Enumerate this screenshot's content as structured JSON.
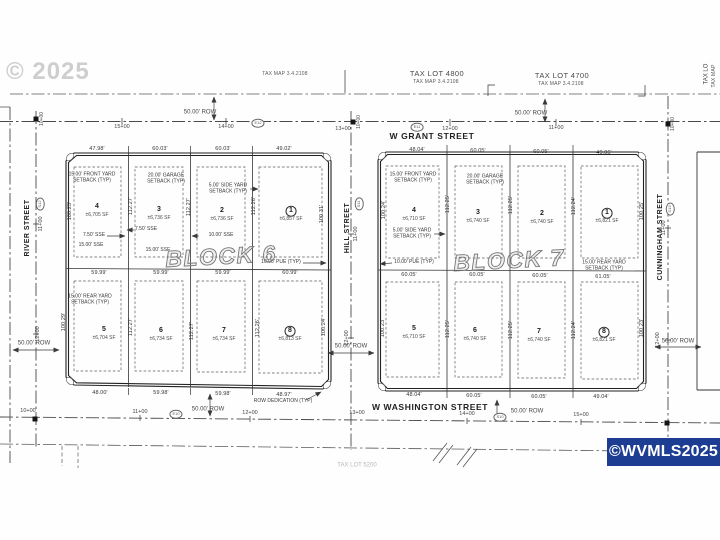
{
  "watermarks": {
    "year": "© 2025",
    "mls": "©WVMLS2025"
  },
  "blocks": [
    {
      "title": "BLOCK 6",
      "title_x": 221,
      "title_y": 257,
      "lots": [
        {
          "n": "4",
          "sf": "±6,705 SF",
          "x": 97,
          "y": 207,
          "circled": false
        },
        {
          "n": "3",
          "sf": "±6,736 SF",
          "x": 159,
          "y": 210,
          "circled": false
        },
        {
          "n": "2",
          "sf": "±6,736 SF",
          "x": 222,
          "y": 211,
          "circled": false
        },
        {
          "n": "1",
          "sf": "±6,857 SF",
          "x": 291,
          "y": 211,
          "circled": true
        },
        {
          "n": "5",
          "sf": "±6,704 SF",
          "x": 104,
          "y": 330,
          "circled": false
        },
        {
          "n": "6",
          "sf": "±6,734 SF",
          "x": 161,
          "y": 331,
          "circled": false
        },
        {
          "n": "7",
          "sf": "±6,734 SF",
          "x": 224,
          "y": 331,
          "circled": false
        },
        {
          "n": "8",
          "sf": "±6,813 SF",
          "x": 290,
          "y": 331,
          "circled": true
        }
      ],
      "dims_top": [
        {
          "t": "47.98'",
          "x": 97,
          "y": 149
        },
        {
          "t": "60.03'",
          "x": 160,
          "y": 149
        },
        {
          "t": "60.03'",
          "x": 223,
          "y": 149
        },
        {
          "t": "49.02'",
          "x": 284,
          "y": 149
        }
      ],
      "dims_mid": [
        {
          "t": "59.99'",
          "x": 99,
          "y": 273
        },
        {
          "t": "59.99'",
          "x": 161,
          "y": 273
        },
        {
          "t": "59.99'",
          "x": 223,
          "y": 273
        },
        {
          "t": "60.99'",
          "x": 290,
          "y": 273
        }
      ],
      "dims_bottom": [
        {
          "t": "48.00'",
          "x": 100,
          "y": 393
        },
        {
          "t": "59.98'",
          "x": 161,
          "y": 393
        },
        {
          "t": "59.98'",
          "x": 223,
          "y": 394
        },
        {
          "t": "48.97'",
          "x": 284,
          "y": 395
        }
      ],
      "vdims": [
        {
          "t": "100.25'",
          "x": 70,
          "y": 211
        },
        {
          "t": "112.27'",
          "x": 131,
          "y": 206
        },
        {
          "t": "112.27'",
          "x": 189,
          "y": 207
        },
        {
          "t": "112.26'",
          "x": 254,
          "y": 206
        },
        {
          "t": "100.31'",
          "x": 322,
          "y": 214
        },
        {
          "t": "100.29'",
          "x": 64,
          "y": 322
        },
        {
          "t": "112.27'",
          "x": 131,
          "y": 327
        },
        {
          "t": "112.27'",
          "x": 192,
          "y": 331
        },
        {
          "t": "112.26'",
          "x": 258,
          "y": 328
        },
        {
          "t": "100.24'",
          "x": 324,
          "y": 327
        }
      ]
    },
    {
      "title": "BLOCK 7",
      "title_x": 509,
      "title_y": 261,
      "lots": [
        {
          "n": "4",
          "sf": "±6,710 SF",
          "x": 414,
          "y": 211,
          "circled": false
        },
        {
          "n": "3",
          "sf": "±6,740 SF",
          "x": 478,
          "y": 213,
          "circled": false
        },
        {
          "n": "2",
          "sf": "±6,740 SF",
          "x": 542,
          "y": 214,
          "circled": false
        },
        {
          "n": "1",
          "sf": "±6,821 SF",
          "x": 607,
          "y": 213,
          "circled": true
        },
        {
          "n": "5",
          "sf": "±6,710 SF",
          "x": 414,
          "y": 329,
          "circled": false
        },
        {
          "n": "6",
          "sf": "±6,740 SF",
          "x": 475,
          "y": 331,
          "circled": false
        },
        {
          "n": "7",
          "sf": "±6,740 SF",
          "x": 539,
          "y": 332,
          "circled": false
        },
        {
          "n": "8",
          "sf": "±6,821 SF",
          "x": 604,
          "y": 332,
          "circled": true
        }
      ],
      "dims_top": [
        {
          "t": "48.04'",
          "x": 417,
          "y": 150
        },
        {
          "t": "60.05'",
          "x": 478,
          "y": 151
        },
        {
          "t": "60.05'",
          "x": 541,
          "y": 152
        },
        {
          "t": "49.06'",
          "x": 604,
          "y": 153
        }
      ],
      "dims_mid": [
        {
          "t": "60.05'",
          "x": 409,
          "y": 275
        },
        {
          "t": "60.05'",
          "x": 477,
          "y": 275
        },
        {
          "t": "60.05'",
          "x": 540,
          "y": 276
        },
        {
          "t": "61.05'",
          "x": 603,
          "y": 277
        }
      ],
      "dims_bottom": [
        {
          "t": "48.04'",
          "x": 414,
          "y": 395
        },
        {
          "t": "60.05'",
          "x": 474,
          "y": 396
        },
        {
          "t": "60.05'",
          "x": 539,
          "y": 397
        },
        {
          "t": "49.04'",
          "x": 601,
          "y": 397
        }
      ],
      "vdims": [
        {
          "t": "100.24'",
          "x": 384,
          "y": 210
        },
        {
          "t": "112.25'",
          "x": 448,
          "y": 204
        },
        {
          "t": "112.25'",
          "x": 511,
          "y": 205
        },
        {
          "t": "112.24'",
          "x": 574,
          "y": 206
        },
        {
          "t": "100.25'",
          "x": 642,
          "y": 211
        },
        {
          "t": "100.23'",
          "x": 383,
          "y": 328
        },
        {
          "t": "112.25'",
          "x": 448,
          "y": 329
        },
        {
          "t": "112.25'",
          "x": 511,
          "y": 330
        },
        {
          "t": "112.24'",
          "x": 574,
          "y": 330
        },
        {
          "t": "100.23'",
          "x": 642,
          "y": 328
        }
      ]
    }
  ],
  "annotations": [
    {
      "name": "tax-map-west-label",
      "cls": "taxmap",
      "t": "TAX MAP 3.4.2108",
      "x": 285,
      "y": 75
    },
    {
      "name": "tax-lot-4800-label",
      "cls": "taxlot",
      "t": "TAX LOT 4800",
      "x": 437,
      "y": 74
    },
    {
      "name": "tax-lot-4800-map-label",
      "cls": "taxmap",
      "t": "TAX MAP 3.4.2108",
      "x": 436,
      "y": 83
    },
    {
      "name": "tax-lot-4700-label",
      "cls": "taxlot",
      "t": "TAX LOT 4700",
      "x": 562,
      "y": 76
    },
    {
      "name": "tax-lot-4700-map-label",
      "cls": "taxmap",
      "t": "TAX MAP 3.4.2108",
      "x": 561,
      "y": 85
    },
    {
      "name": "tax-lot-east-label",
      "cls": "t6",
      "t": "TAX LO",
      "x": 707,
      "y": 74,
      "r": -90
    },
    {
      "name": "tax-map-east-label",
      "cls": "taxmap",
      "t": "TAX MAP",
      "x": 715,
      "y": 76,
      "r": -90
    },
    {
      "name": "tax-lot-south-label",
      "cls": "t6 faint",
      "t": "TAX LOT 5200",
      "x": 357,
      "y": 466
    },
    {
      "name": "street-name-w-grant",
      "cls": "street-h",
      "t": "W GRANT STREET",
      "x": 432,
      "y": 137
    },
    {
      "name": "street-name-w-washington",
      "cls": "street-h",
      "t": "W WASHINGTON STREET",
      "x": 430,
      "y": 408
    },
    {
      "name": "street-name-river",
      "cls": "street-v",
      "t": "RIVER STREET",
      "x": 28,
      "y": 228,
      "r": -90
    },
    {
      "name": "street-name-hill",
      "cls": "street-v",
      "t": "HILL STREET",
      "x": 348,
      "y": 228,
      "r": -90
    },
    {
      "name": "street-name-cunningham",
      "cls": "street-v",
      "t": "CUNNINGHAM STREET",
      "x": 661,
      "y": 237,
      "r": -90
    },
    {
      "name": "row-width-label",
      "cls": "t6",
      "t": "50.00' ROW",
      "x": 200,
      "y": 113
    },
    {
      "name": "row-width-label",
      "cls": "t6",
      "t": "50.00' ROW",
      "x": 531,
      "y": 114
    },
    {
      "name": "row-width-label",
      "cls": "t6",
      "t": "50.00' ROW",
      "x": 208,
      "y": 410
    },
    {
      "name": "row-width-label",
      "cls": "t6",
      "t": "50.00' ROW",
      "x": 527,
      "y": 412
    },
    {
      "name": "row-width-label",
      "cls": "t6",
      "t": "50.00' ROW",
      "x": 34,
      "y": 344
    },
    {
      "name": "row-width-label",
      "cls": "t6",
      "t": "50.00' ROW",
      "x": 351,
      "y": 347
    },
    {
      "name": "row-width-label",
      "cls": "t6",
      "t": "50.00' ROW",
      "x": 678,
      "y": 342
    },
    {
      "name": "station-label",
      "cls": "station",
      "t": "10+00",
      "x": 28,
      "y": 411
    },
    {
      "name": "station-label",
      "cls": "station",
      "t": "11+00",
      "x": 140,
      "y": 412
    },
    {
      "name": "station-label",
      "cls": "station",
      "t": "12+00",
      "x": 250,
      "y": 413
    },
    {
      "name": "station-label",
      "cls": "station",
      "t": "13+00",
      "x": 357,
      "y": 413
    },
    {
      "name": "station-label",
      "cls": "station",
      "t": "14+00",
      "x": 467,
      "y": 414
    },
    {
      "name": "station-label",
      "cls": "station",
      "t": "15+00",
      "x": 581,
      "y": 415
    },
    {
      "name": "station-label",
      "cls": "station",
      "t": "15+00",
      "x": 122,
      "y": 127
    },
    {
      "name": "station-label",
      "cls": "station",
      "t": "14+00",
      "x": 226,
      "y": 127
    },
    {
      "name": "station-label",
      "cls": "station",
      "t": "13+00",
      "x": 343,
      "y": 129
    },
    {
      "name": "station-label",
      "cls": "station",
      "t": "12+00",
      "x": 450,
      "y": 129
    },
    {
      "name": "station-label",
      "cls": "station",
      "t": "11+00",
      "x": 556,
      "y": 128
    },
    {
      "name": "station-label",
      "cls": "station",
      "t": "11+00",
      "x": 41,
      "y": 224,
      "r": -90
    },
    {
      "name": "station-label",
      "cls": "station",
      "t": "12+00",
      "x": 38,
      "y": 334,
      "r": -90
    },
    {
      "name": "station-label",
      "cls": "station",
      "t": "11+00",
      "x": 356,
      "y": 234,
      "r": -90
    },
    {
      "name": "station-label",
      "cls": "station",
      "t": "12+00",
      "x": 347,
      "y": 338,
      "r": -90
    },
    {
      "name": "station-label",
      "cls": "station",
      "t": "11+00",
      "x": 664,
      "y": 228,
      "r": -90
    },
    {
      "name": "station-label",
      "cls": "station",
      "t": "12+00",
      "x": 658,
      "y": 340,
      "r": -90
    },
    {
      "name": "station-label",
      "cls": "t5",
      "t": "10+00",
      "x": 43,
      "y": 119,
      "r": -90
    },
    {
      "name": "station-label",
      "cls": "t5",
      "t": "10+00",
      "x": 360,
      "y": 122,
      "r": -90
    },
    {
      "name": "station-label",
      "cls": "t5",
      "t": "10+00",
      "x": 674,
      "y": 124,
      "r": -90
    },
    {
      "name": "station-ref-oval",
      "cls": "oval",
      "t": "E12",
      "x": 258,
      "y": 123
    },
    {
      "name": "station-ref-oval",
      "cls": "oval",
      "t": "E11",
      "x": 417,
      "y": 127
    },
    {
      "name": "station-ref-oval",
      "cls": "oval",
      "t": "S12",
      "x": 40,
      "y": 204,
      "r": -90
    },
    {
      "name": "station-ref-oval",
      "cls": "oval",
      "t": "S11",
      "x": 359,
      "y": 204,
      "r": -90
    },
    {
      "name": "station-ref-oval",
      "cls": "oval",
      "t": "S13",
      "x": 670,
      "y": 209,
      "r": -90
    },
    {
      "name": "station-ref-oval",
      "cls": "oval",
      "t": "E10",
      "x": 176,
      "y": 414
    },
    {
      "name": "station-ref-oval",
      "cls": "oval",
      "t": "S10",
      "x": 500,
      "y": 417
    },
    {
      "name": "setback-note",
      "cls": "note",
      "t": "15.00' FRONT YARD\nSETBACK (TYP)",
      "x": 92,
      "y": 178
    },
    {
      "name": "setback-note",
      "cls": "note",
      "t": "20.00' GARAGE\nSETBACK (TYP)",
      "x": 166,
      "y": 179
    },
    {
      "name": "setback-note",
      "cls": "note",
      "t": "5.00' SIDE YARD\nSETBACK (TYP)",
      "x": 228,
      "y": 189
    },
    {
      "name": "easement-note",
      "cls": "note",
      "t": "7.50' SSE",
      "x": 94,
      "y": 236
    },
    {
      "name": "easement-note",
      "cls": "note",
      "t": "15.00' SSE",
      "x": 91,
      "y": 246
    },
    {
      "name": "easement-note",
      "cls": "note",
      "t": "7.50' SSE",
      "x": 146,
      "y": 230
    },
    {
      "name": "easement-note",
      "cls": "note",
      "t": "10.00' SSE",
      "x": 221,
      "y": 236
    },
    {
      "name": "easement-note",
      "cls": "note",
      "t": "15.00' SSE",
      "x": 158,
      "y": 251
    },
    {
      "name": "easement-note",
      "cls": "note",
      "t": "10.00' PUE (TYP)",
      "x": 281,
      "y": 263
    },
    {
      "name": "setback-note",
      "cls": "note",
      "t": "15.00' REAR YARD\nSETBACK (TYP)",
      "x": 90,
      "y": 300
    },
    {
      "name": "row-dedication-note",
      "cls": "note",
      "t": "ROW DEDICATION (TYP)",
      "x": 283,
      "y": 402
    },
    {
      "name": "setback-note",
      "cls": "note",
      "t": "15.00' FRONT YARD\nSETBACK (TYP)",
      "x": 413,
      "y": 178
    },
    {
      "name": "setback-note",
      "cls": "note",
      "t": "20.00' GARAGE\nSETBACK (TYP)",
      "x": 485,
      "y": 180
    },
    {
      "name": "setback-note",
      "cls": "note",
      "t": "5.00' SIDE YARD\nSETBACK (TYP)",
      "x": 412,
      "y": 234
    },
    {
      "name": "easement-note",
      "cls": "note",
      "t": "10.00' PUE (TYP)",
      "x": 414,
      "y": 263
    },
    {
      "name": "setback-note",
      "cls": "note",
      "t": "15.00' REAR YARD\nSETBACK (TYP)",
      "x": 604,
      "y": 266
    }
  ]
}
